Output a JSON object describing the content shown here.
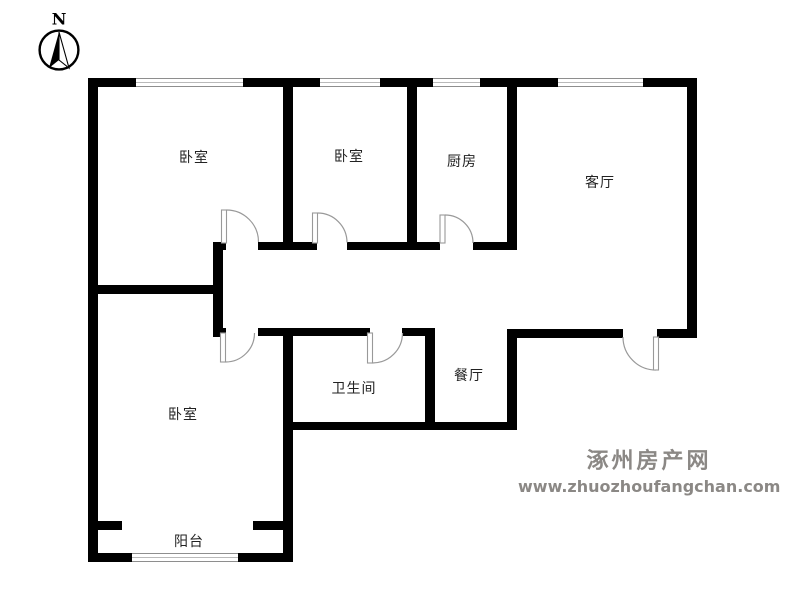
{
  "compass": {
    "north_label": "N"
  },
  "rooms": [
    {
      "id": "bedroom-1",
      "label": "卧室"
    },
    {
      "id": "bedroom-2",
      "label": "卧室"
    },
    {
      "id": "kitchen",
      "label": "厨房"
    },
    {
      "id": "living-room",
      "label": "客厅"
    },
    {
      "id": "bathroom",
      "label": "卫生间"
    },
    {
      "id": "dining-room",
      "label": "餐厅"
    },
    {
      "id": "bedroom-3",
      "label": "卧室"
    },
    {
      "id": "balcony",
      "label": "阳台"
    }
  ],
  "watermark": {
    "site_name": "涿州房产网",
    "site_url": "www.zhuozhoufangchan.com"
  },
  "colors": {
    "wall": "#000000",
    "door_arc": "#999999",
    "window_frame": "#8e8e8e",
    "watermark_text": "#8b8885",
    "room_label": "#222222"
  }
}
